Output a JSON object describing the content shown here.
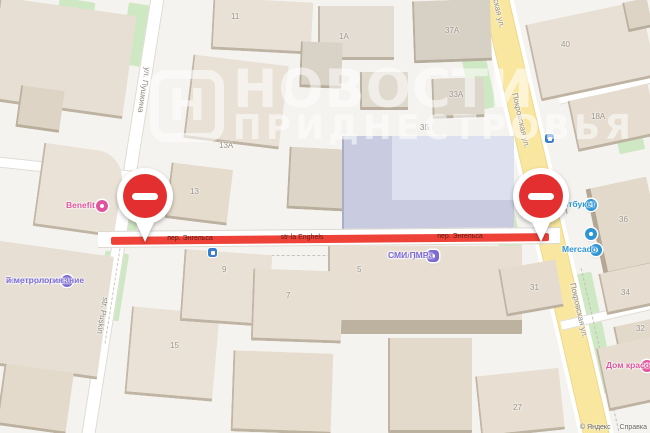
{
  "watermark": {
    "logo_letter": "Н",
    "title_line1": "НОВОСТИ",
    "title_line2": "ПРИДНЕСТРОВЬЯ"
  },
  "attribution": {
    "copyright": "© Яндекс",
    "help": "Справка"
  },
  "road_closure_labels": [
    {
      "text": "пер. Энгельса"
    },
    {
      "text": "str-la Enghels"
    },
    {
      "text": "пер. Энгельса"
    }
  ],
  "street_labels": [
    {
      "text": "Покровская ул."
    },
    {
      "text": "Покровская ул."
    },
    {
      "text": "Покровская ул."
    },
    {
      "text": "ул. Пушкина"
    },
    {
      "text": "str. Pușkin"
    }
  ],
  "pois": [
    {
      "name": "Benefit",
      "color": "#e0549b"
    },
    {
      "name": "Техрегулирование и метрология",
      "line1": "Техрегулирование",
      "line2": "и метрология",
      "color": "#7d6bd0"
    },
    {
      "name": "Госслужба СМИ ПМР",
      "line1": "Госслужба",
      "line2": "СМИ ПМР",
      "color": "#7d6bd0"
    },
    {
      "name": "Артбукет",
      "glyph": "✿",
      "color": "#2e95d5"
    },
    {
      "name": "Mercado",
      "color": "#2e95d5"
    },
    {
      "name": "Дом красоты",
      "glyph": "✿",
      "color": "#e0549b"
    }
  ],
  "building_numbers": [
    {
      "text": "11"
    },
    {
      "text": "1А"
    },
    {
      "text": "37А"
    },
    {
      "text": "40"
    },
    {
      "text": "33А"
    },
    {
      "text": "3Б"
    },
    {
      "text": "13А"
    },
    {
      "text": "13"
    },
    {
      "text": "18А"
    },
    {
      "text": "36"
    },
    {
      "text": "9"
    },
    {
      "text": "5"
    },
    {
      "text": "7"
    },
    {
      "text": "31"
    },
    {
      "text": "34"
    },
    {
      "text": "32"
    },
    {
      "text": "15"
    },
    {
      "text": "27"
    }
  ],
  "colors": {
    "closure_road": "#ee4238",
    "no_entry_sign": "#e32f2f",
    "main_road_fill": "#f9e7a0",
    "building_fill": "#e8e0d4",
    "selected_building_fill": "#cdd0e2",
    "green_area": "#cfe8c4",
    "poi_pink": "#e0549b",
    "poi_blue": "#2e95d5",
    "poi_purple": "#7d6bd0",
    "transport_stop_blue": "#3a7ecb",
    "watermark": "#ffffff"
  }
}
